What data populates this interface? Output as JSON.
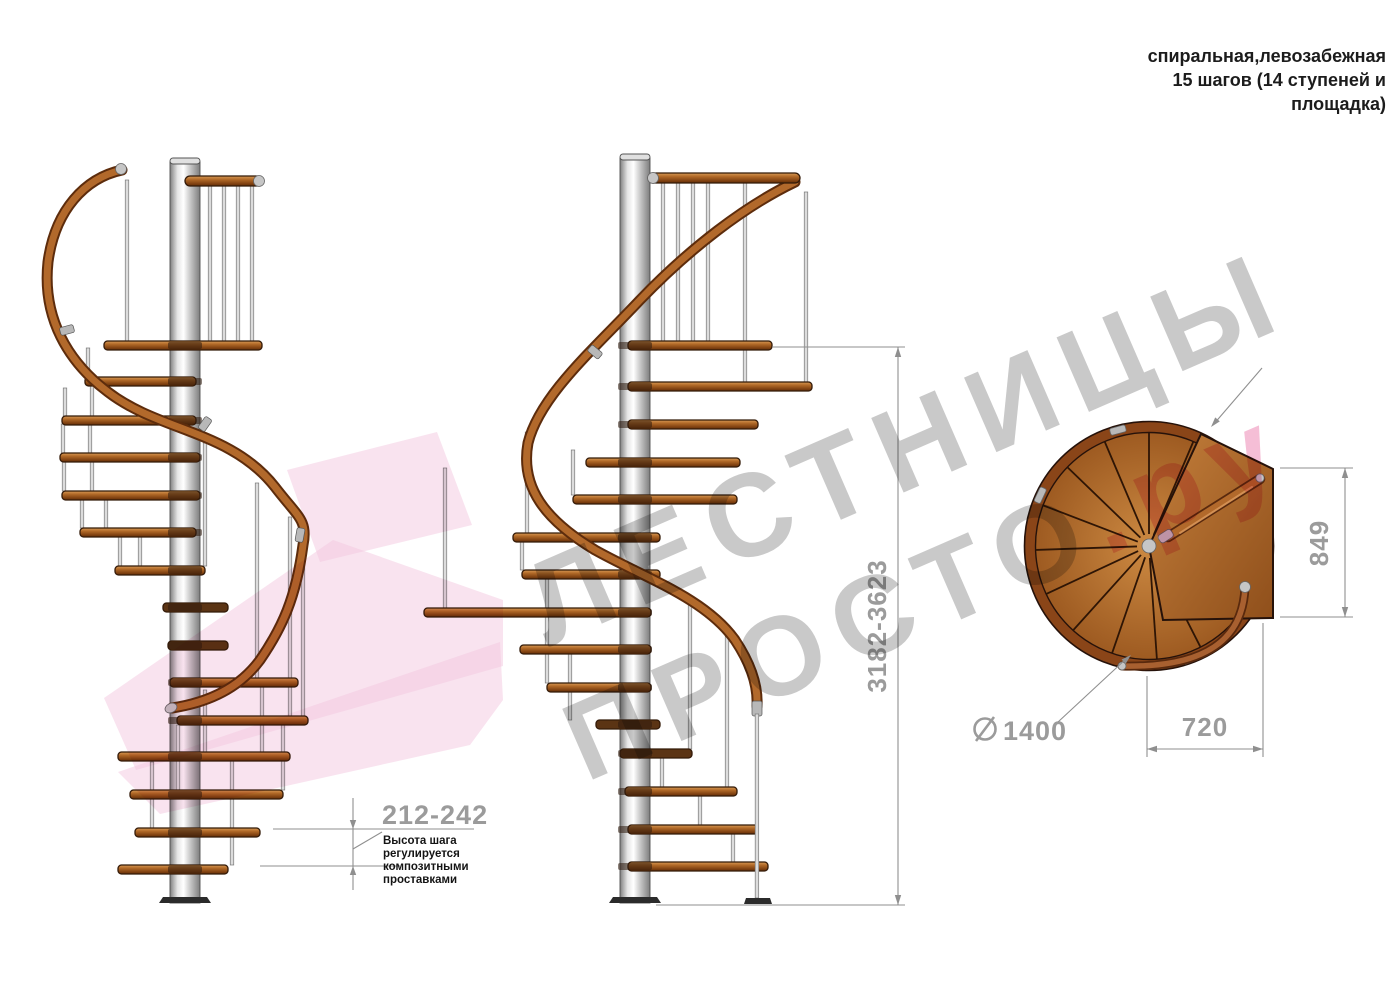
{
  "header": {
    "lines": [
      "спиральная,левозабежная",
      "15 шагов (14 ступеней и",
      "площадка)"
    ]
  },
  "watermark": {
    "line1": "ЛЕСТНИЦЫ",
    "line2": "ПРОСТО",
    "suffix": ".ру",
    "text_color": "#c9c9c9",
    "suffix_color": "#f5bed6",
    "arrow_color": "#f3c8e0"
  },
  "dimensions": {
    "step_height": {
      "value": "212-242",
      "note_lines": [
        "Высота шага",
        "регулируется",
        "композитными",
        "проставками"
      ]
    },
    "total_height": {
      "value": "3182-3623"
    },
    "landing_depth": {
      "value": "849"
    },
    "step_length": {
      "value": "720"
    },
    "diameter": {
      "symbol": "⌀",
      "value": "1400"
    }
  },
  "colors": {
    "wood": "#b2692b",
    "wood_outline": "#5d2c0c",
    "steel": "#d9d9d9",
    "dimension_gray": "#9b9b9b",
    "note_text": "#141414",
    "background": "#ffffff"
  }
}
